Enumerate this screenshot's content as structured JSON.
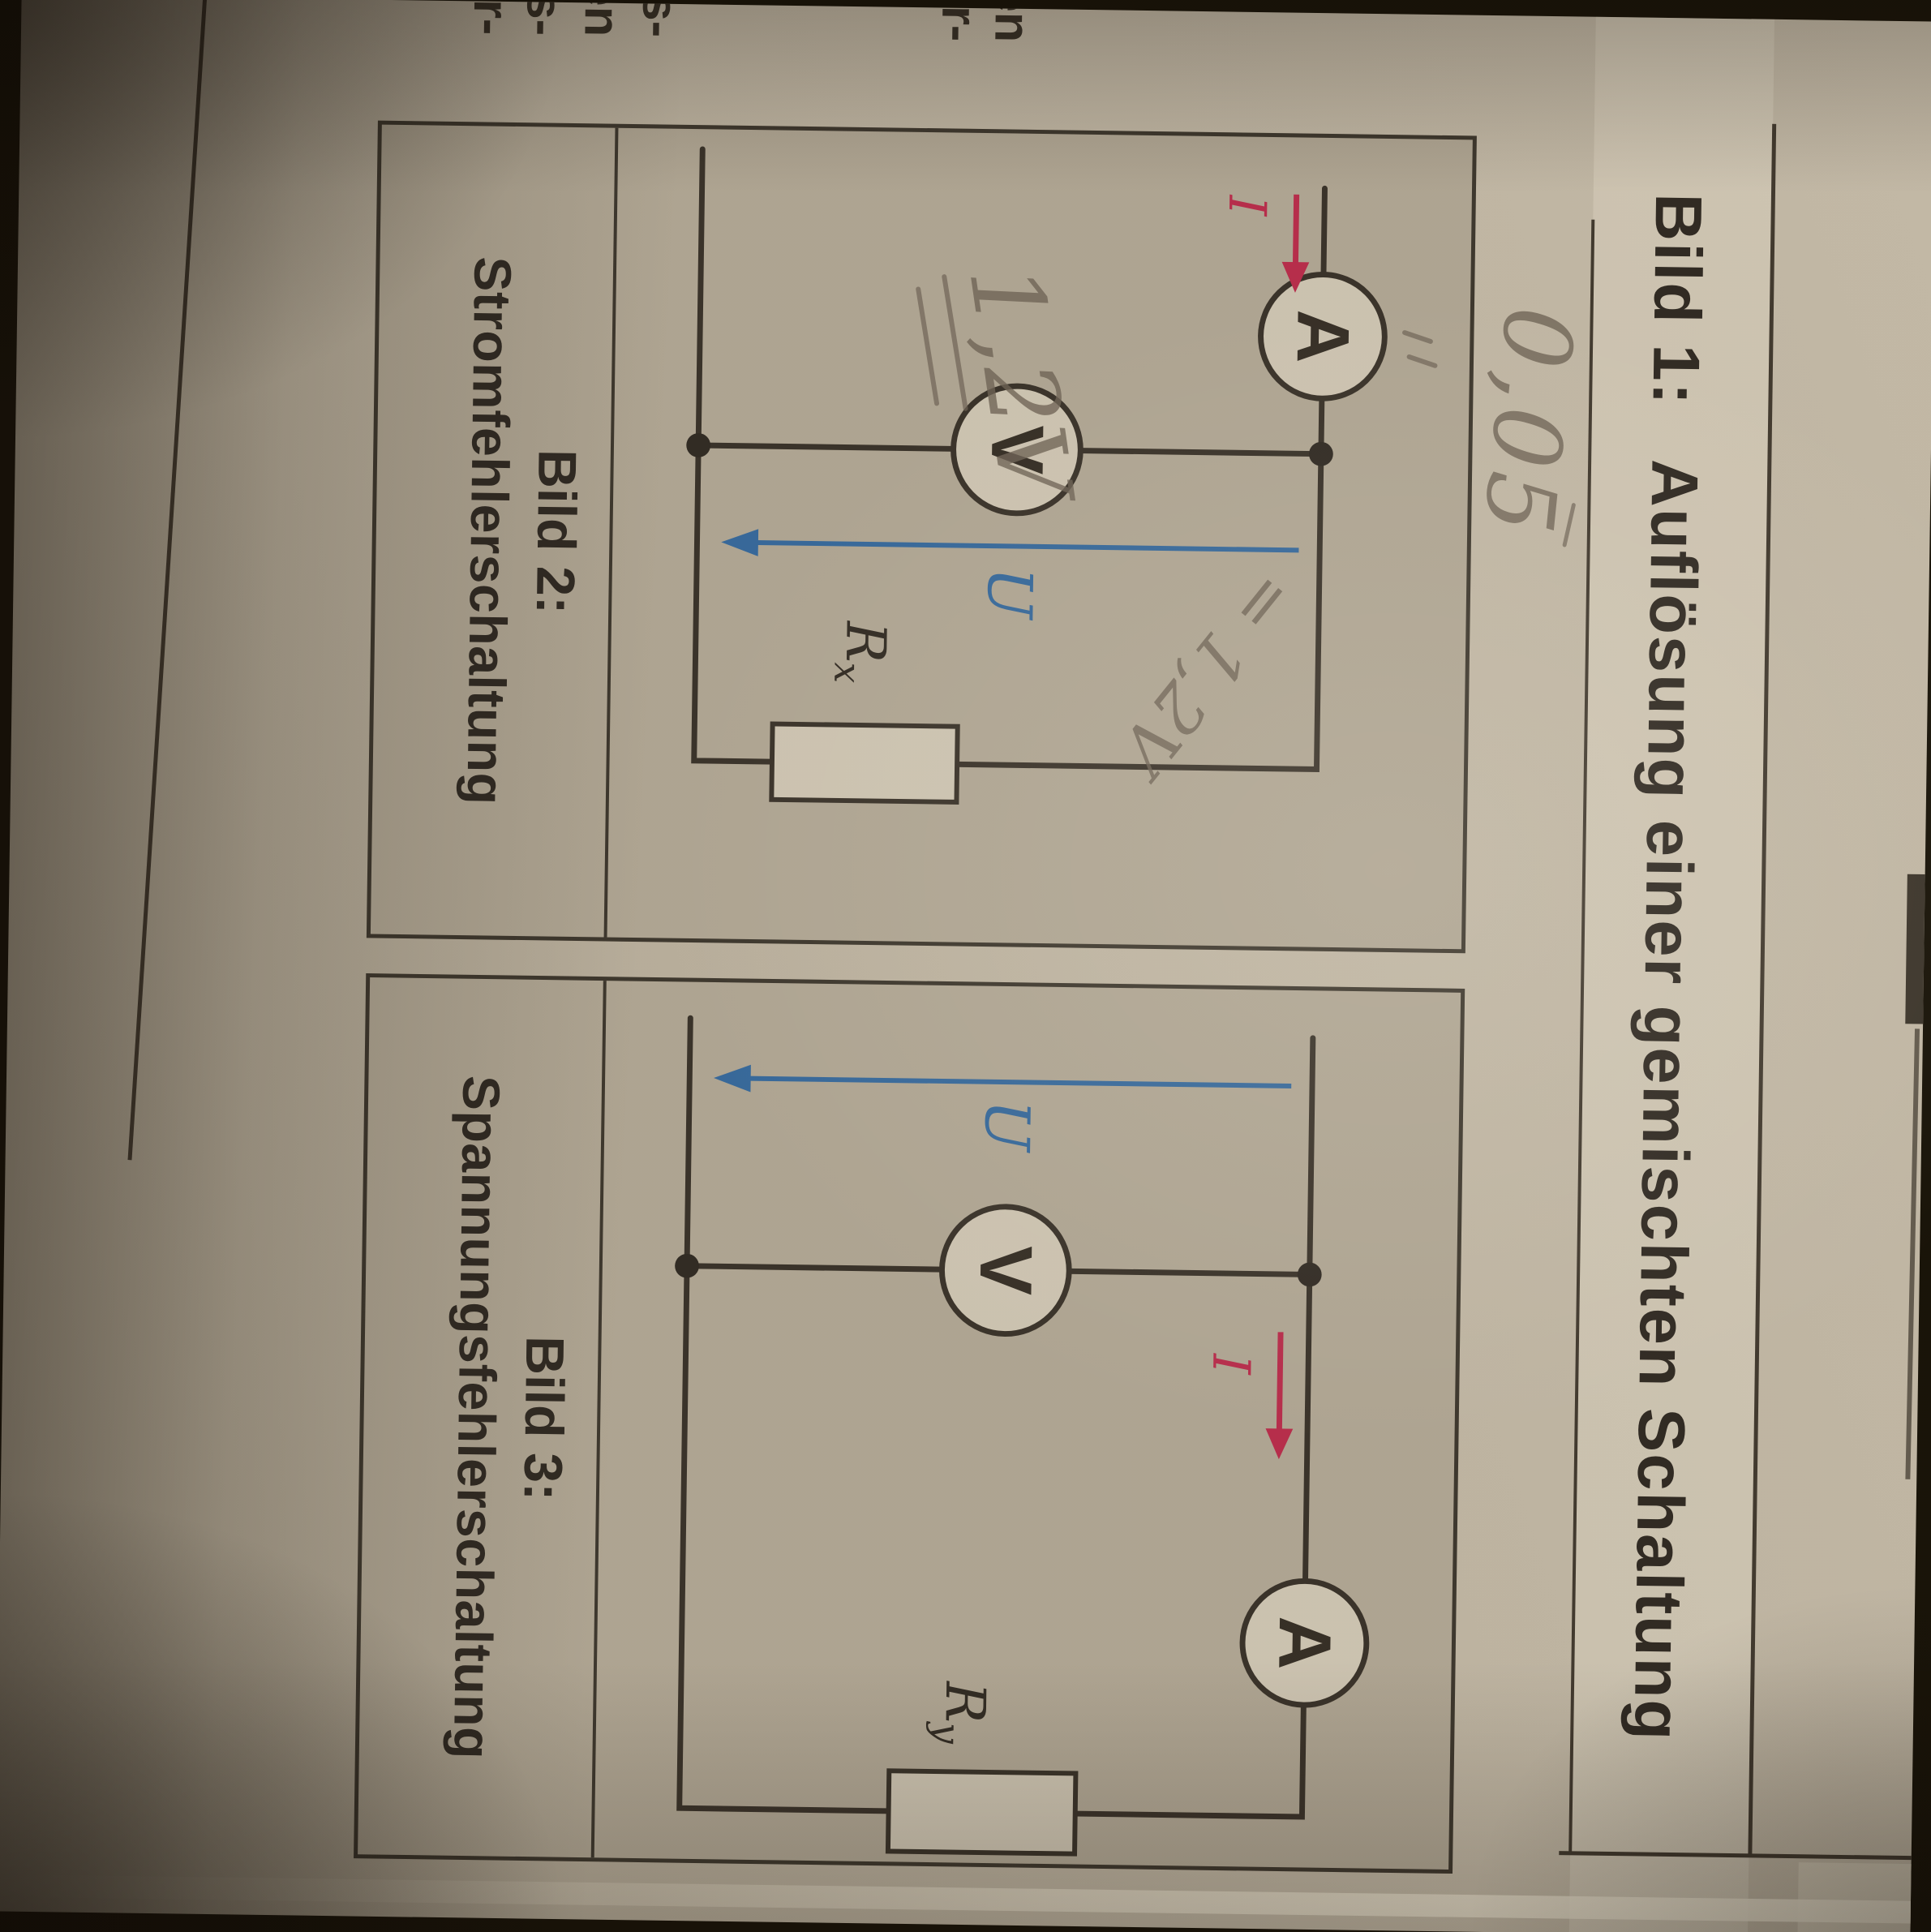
{
  "page": {
    "title": {
      "label": "Bild 1:",
      "text": "Auflösung einer gemischten Schaltung"
    },
    "figures": [
      {
        "caption_label": "Bild 2:",
        "caption_text": "Stromfehlerschaltung",
        "ammeter": "A",
        "voltmeter": "V",
        "current_label": "I",
        "voltage_label": "U",
        "resistor_label": "R",
        "resistor_sub": "x"
      },
      {
        "caption_label": "Bild 3:",
        "caption_text": "Spannungsfehlerschaltung",
        "ammeter": "A",
        "voltmeter": "V",
        "current_label": "I",
        "voltage_label": "U",
        "resistor_label": "R",
        "resistor_sub": "y"
      }
    ],
    "annotations": {
      "above_box": "0,05",
      "beside_voltmeter": "1,2V",
      "beside_u_arrow": "= 1,2V"
    },
    "edge_fragments": [
      "en",
      "er-",
      "ngs-",
      "den",
      "s-",
      "r-"
    ],
    "colors": {
      "accent_red": "#b92b4d",
      "accent_blue": "#34699f",
      "pencil": "#6e6458",
      "ink": "#2d2823",
      "wire": "#37312a"
    }
  }
}
